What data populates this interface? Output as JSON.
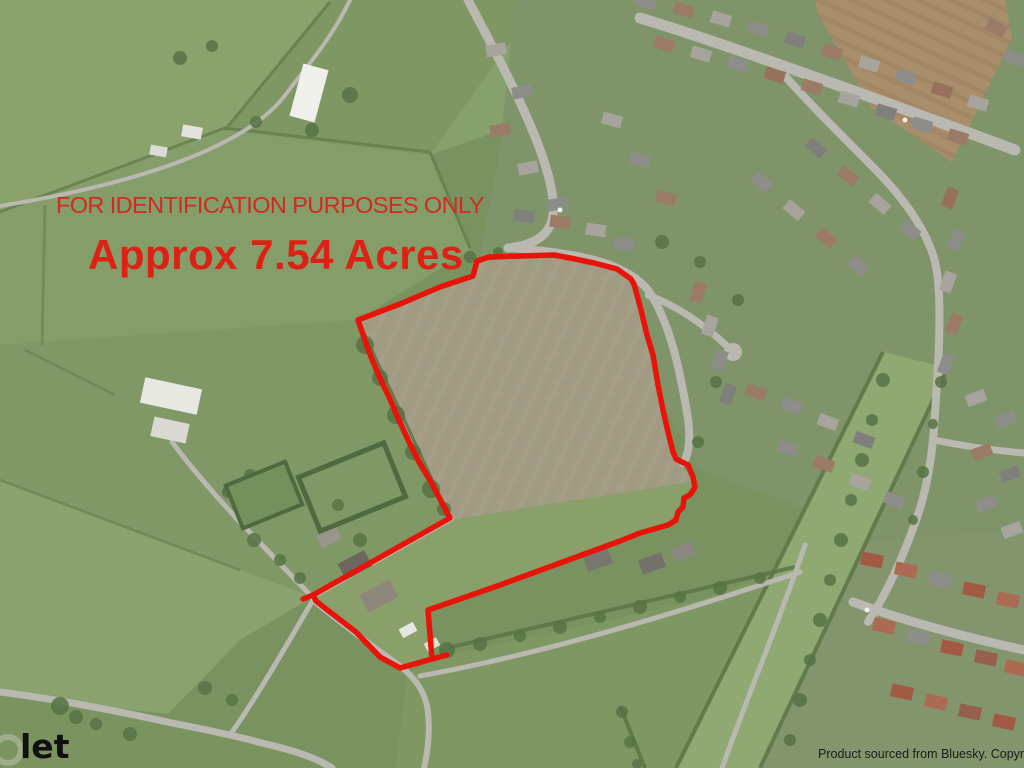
{
  "map": {
    "type": "aerial-photograph",
    "overlay": {
      "notice": "FOR IDENTIFICATION PURPOSES ONLY",
      "area_label": "Approx 7.54 Acres",
      "watermark": "let",
      "attribution": "Product sourced from Bluesky. Copyright Prote",
      "colors": {
        "boundary": "#e81309",
        "notice_text": "#cf2b22",
        "area_text": "#dd2114",
        "watermark_text": "#101010",
        "attribution_text": "#1c1c1c"
      },
      "boundary_points": [
        [
          358,
          320
        ],
        [
          400,
          304
        ],
        [
          440,
          287
        ],
        [
          473,
          276
        ],
        [
          477,
          261
        ],
        [
          489,
          257
        ],
        [
          554,
          255
        ],
        [
          570,
          258
        ],
        [
          594,
          263
        ],
        [
          617,
          269
        ],
        [
          631,
          279
        ],
        [
          634,
          284
        ],
        [
          641,
          310
        ],
        [
          647,
          335
        ],
        [
          653,
          355
        ],
        [
          658,
          385
        ],
        [
          663,
          410
        ],
        [
          668,
          432
        ],
        [
          673,
          452
        ],
        [
          676,
          459
        ],
        [
          688,
          465
        ],
        [
          693,
          477
        ],
        [
          695,
          487
        ],
        [
          690,
          495
        ],
        [
          684,
          498
        ],
        [
          683,
          507
        ],
        [
          678,
          512
        ],
        [
          676,
          520
        ],
        [
          668,
          525
        ],
        [
          640,
          533
        ],
        [
          620,
          541
        ],
        [
          560,
          563
        ],
        [
          500,
          585
        ],
        [
          460,
          599
        ],
        [
          428,
          610
        ],
        [
          432,
          659
        ],
        [
          400,
          668
        ],
        [
          380,
          657
        ],
        [
          356,
          632
        ],
        [
          330,
          612
        ],
        [
          316,
          601
        ],
        [
          313,
          595
        ],
        [
          450,
          518
        ],
        [
          441,
          501
        ],
        [
          431,
          482
        ],
        [
          419,
          462
        ],
        [
          409,
          442
        ],
        [
          399,
          420
        ],
        [
          389,
          397
        ],
        [
          379,
          376
        ],
        [
          369,
          352
        ]
      ],
      "boundary_overshoot": [
        [
          432,
          659
        ],
        [
          447,
          655
        ]
      ],
      "boundary_spur": [
        [
          313,
          595
        ],
        [
          303,
          599
        ]
      ]
    }
  }
}
